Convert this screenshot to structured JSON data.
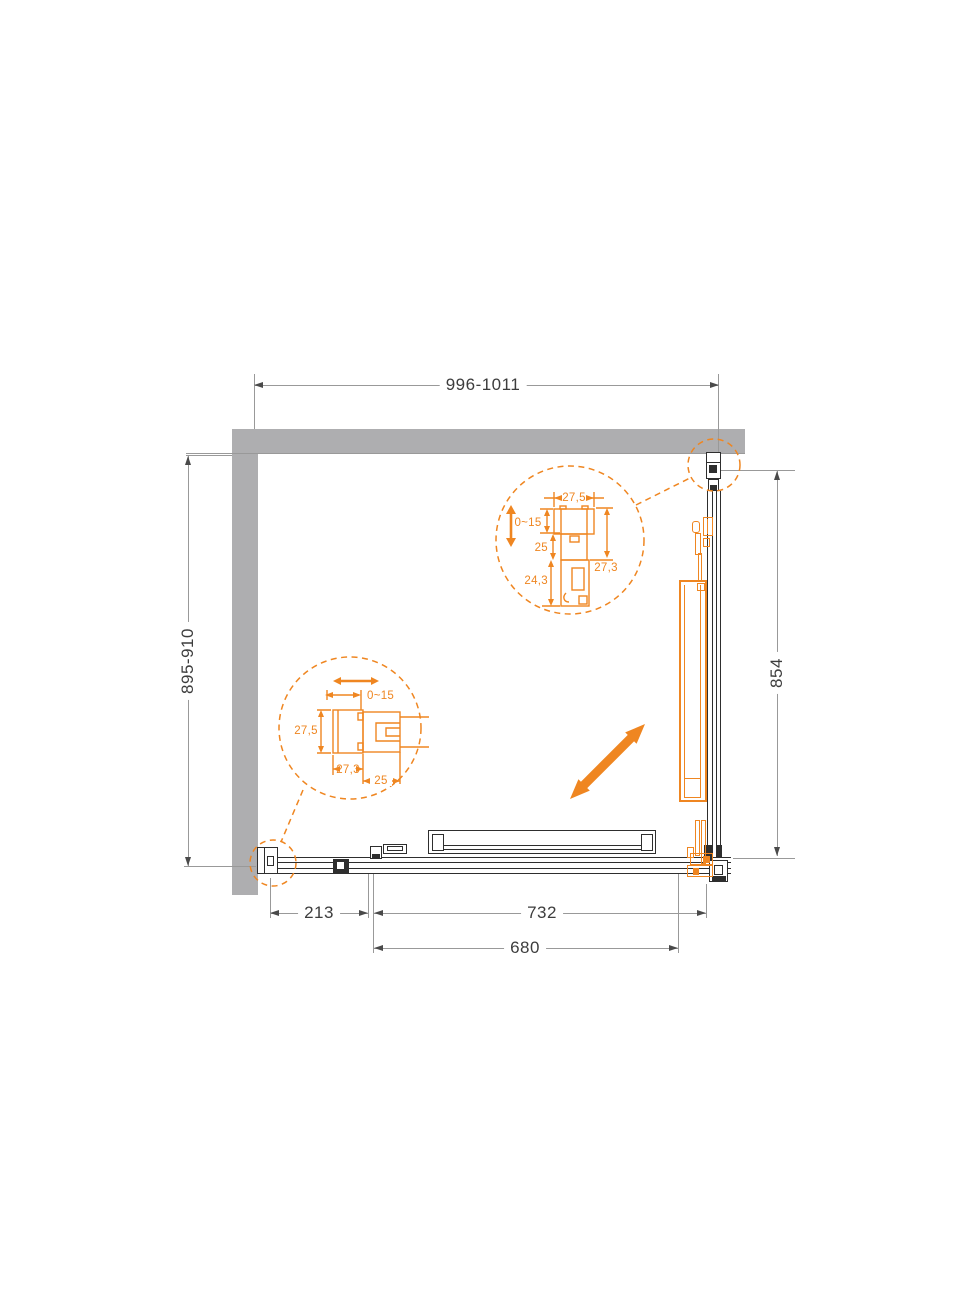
{
  "dimensions": {
    "top_width": "996-1011",
    "left_depth": "895-910",
    "right_side": "854",
    "bottom_fixed_panel": "213",
    "bottom_opening": "732",
    "bottom_door": "680"
  },
  "detail_top": {
    "profile_width": "27,5",
    "adjustment": "0~15",
    "dim_mid": "25",
    "dim_lower": "24,3",
    "dim_side": "27,3"
  },
  "detail_left": {
    "adjustment": "0~15",
    "profile_height": "27,5",
    "dim_width": "27,3",
    "dim_depth": "25"
  },
  "icons": {
    "slide_direction": "diagonal-double-arrow"
  },
  "colors": {
    "accent_orange": "#EF8621",
    "wall_gray": "#AEAEB0",
    "drawing_line": "#2E2E2E",
    "dimension_line": "#999999",
    "dimension_text": "#3D3D3D"
  }
}
